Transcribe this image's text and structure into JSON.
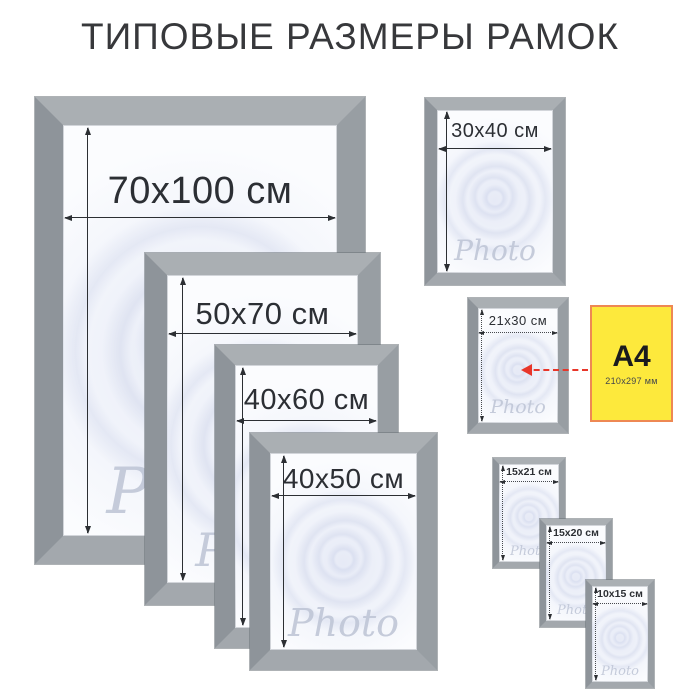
{
  "title": "ТИПОВЫЕ РАЗМЕРЫ РАМОК",
  "watermark": "Photo",
  "frames": [
    {
      "name": "70x100",
      "label": "70x100 см"
    },
    {
      "name": "50x70",
      "label": "50x70 см"
    },
    {
      "name": "40x60",
      "label": "40x60 см"
    },
    {
      "name": "40x50",
      "label": "40x50 см"
    },
    {
      "name": "30x40",
      "label": "30x40 см"
    },
    {
      "name": "21x30",
      "label": "21x30 см"
    },
    {
      "name": "15x21",
      "label": "15x21 см"
    },
    {
      "name": "15x20",
      "label": "15x20 см"
    },
    {
      "name": "10x15",
      "label": "10x15 см"
    }
  ],
  "a4": {
    "label": "A4",
    "sublabel": "210x297 мм"
  },
  "colors": {
    "frame_gray": "#9aa0a5",
    "title_text": "#37383b",
    "dimension_text": "#2c2f34",
    "a4_yellow": "#fde93c",
    "a4_border": "#ee8853",
    "pointer_red": "#e8362a",
    "watermark_gray": "#bdc4d5"
  }
}
